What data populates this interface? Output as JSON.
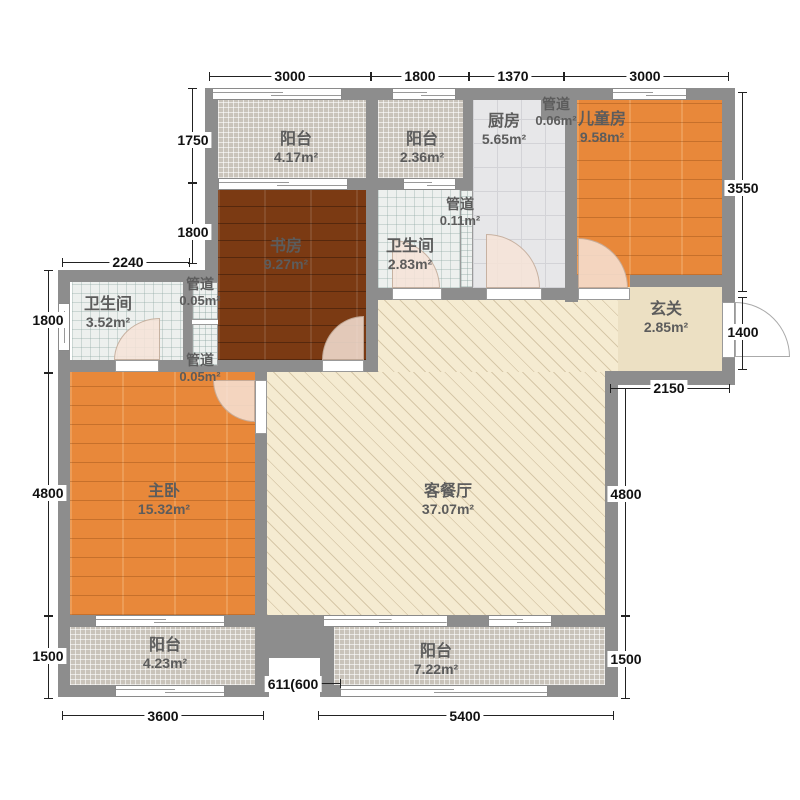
{
  "plan": {
    "title": "三室两厅户型图",
    "rooms": [
      {
        "id": "balcony-top-left",
        "name": "阳台",
        "area": "4.17m²"
      },
      {
        "id": "balcony-top-mid",
        "name": "阳台",
        "area": "2.36m²"
      },
      {
        "id": "kitchen",
        "name": "厨房",
        "area": "5.65m²"
      },
      {
        "id": "duct-top",
        "name": "管道",
        "area": "0.06m²"
      },
      {
        "id": "kids-room",
        "name": "儿童房",
        "area": "9.58m²"
      },
      {
        "id": "bath-mid",
        "name": "卫生间",
        "area": "2.83m²"
      },
      {
        "id": "duct-mid",
        "name": "管道",
        "area": "0.11m²"
      },
      {
        "id": "study",
        "name": "书房",
        "area": "9.27m²"
      },
      {
        "id": "duct-left-upper",
        "name": "管道",
        "area": "0.05m²"
      },
      {
        "id": "bath-left",
        "name": "卫生间",
        "area": "3.52m²"
      },
      {
        "id": "duct-left-lower",
        "name": "管道",
        "area": "0.05m²"
      },
      {
        "id": "entry-hall",
        "name": "玄关",
        "area": "2.85m²"
      },
      {
        "id": "master-bedroom",
        "name": "主卧",
        "area": "15.32m²"
      },
      {
        "id": "living-dining",
        "name": "客餐厅",
        "area": "37.07m²"
      },
      {
        "id": "balcony-bottom-left",
        "name": "阳台",
        "area": "4.23m²"
      },
      {
        "id": "balcony-bottom-mid",
        "name": "阳台",
        "area": "7.22m²"
      }
    ],
    "dimensions": {
      "top": [
        "3000",
        "1800",
        "1370",
        "3000"
      ],
      "left_inner": [
        "1750",
        "1800"
      ],
      "left_top": "2240",
      "left_outer": [
        "1800",
        "4800",
        "1500"
      ],
      "right": [
        "3550",
        "1400",
        "2150",
        "4800",
        "1500"
      ],
      "bottom": [
        "3600",
        "611(600",
        "5400"
      ]
    },
    "colors": {
      "wall": "#8d8d8d",
      "wood_orange": "#e8883a",
      "wood_dark": "#7b3a13",
      "living_cream": "#f5ebd1",
      "balcony_tile": "#c9c3ba",
      "kitchen_tile": "#e7e7e9",
      "bath_tile": "#edf0ee",
      "entry_beige": "#ece0c3",
      "dim_text": "#111111",
      "label_text": "#5c5c5c"
    }
  }
}
